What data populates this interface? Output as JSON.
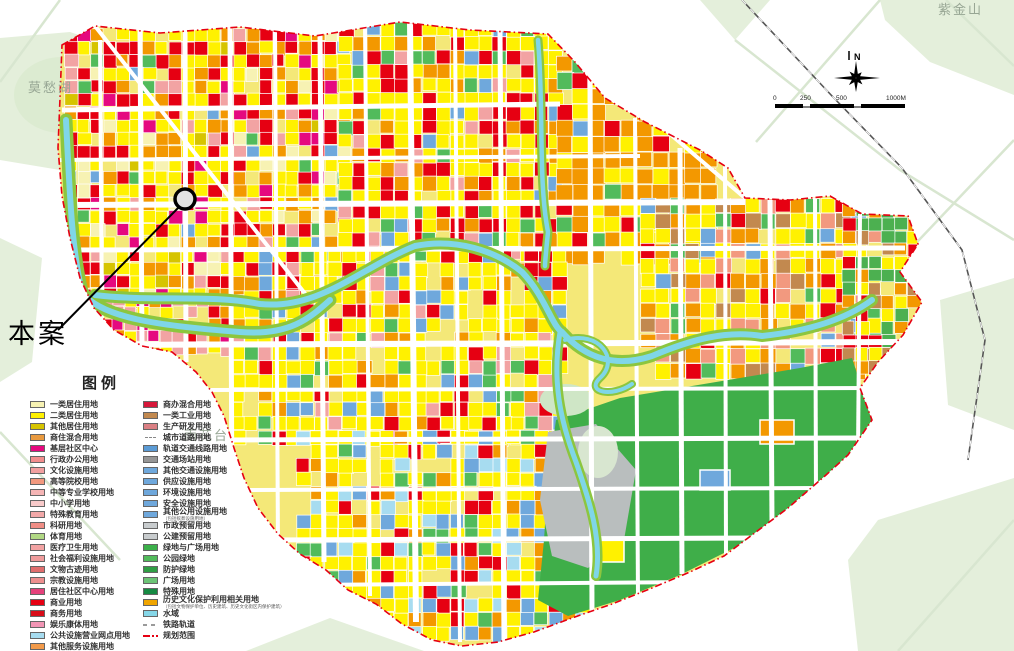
{
  "labels": {
    "site": "本案",
    "mochou_lake": "莫愁湖",
    "yuhuatai": "雨花台",
    "zijinshan": "紫金山",
    "north": "N"
  },
  "scalebar": {
    "ticks": [
      "0",
      "250",
      "500",
      "1000M"
    ]
  },
  "colors": {
    "planning_boundary": "#e60012",
    "water": "#7fd6e8",
    "road": "#ffffff",
    "residential_yellow": "#fff100",
    "commercial_red": "#e60012",
    "mixed_orange": "#f39800",
    "green_space": "#3fae49",
    "park_outside": "#e4efdb"
  },
  "legend": {
    "title": "图例",
    "left": [
      {
        "label": "一类居住用地",
        "color": "#f7f2b3"
      },
      {
        "label": "二类居住用地",
        "color": "#fff100"
      },
      {
        "label": "其他居住用地",
        "color": "#d6c400"
      },
      {
        "label": "商住混合用地",
        "color": "#e99a3f"
      },
      {
        "label": "基层社区中心",
        "color": "#e5097f"
      },
      {
        "label": "行政办公用地",
        "color": "#f28e8e"
      },
      {
        "label": "文化设施用地",
        "color": "#f2a0a0"
      },
      {
        "label": "高等院校用地",
        "color": "#f2997f"
      },
      {
        "label": "中等专业学校用地",
        "color": "#f5b5b5"
      },
      {
        "label": "中小学用地",
        "color": "#f8caca"
      },
      {
        "label": "特殊教育用地",
        "color": "#f2a8a8"
      },
      {
        "label": "科研用地",
        "color": "#f08e86"
      },
      {
        "label": "体育用地",
        "color": "#b1d884"
      },
      {
        "label": "医疗卫生用地",
        "color": "#f2a3a3"
      },
      {
        "label": "社会福利设施用地",
        "color": "#ef9c9c"
      },
      {
        "label": "文物古迹用地",
        "color": "#e06e6e"
      },
      {
        "label": "宗教设施用地",
        "color": "#ed8f8f"
      },
      {
        "label": "居住社区中心用地",
        "color": "#e4417b"
      },
      {
        "label": "商业用地",
        "color": "#e60012"
      },
      {
        "label": "商务用地",
        "color": "#d80c18"
      },
      {
        "label": "娱乐康体用地",
        "color": "#f295b5"
      },
      {
        "label": "公共设施营业网点用地",
        "color": "#a7dcf0"
      },
      {
        "label": "其他服务设施用地",
        "color": "#f39b4b"
      }
    ],
    "right": [
      {
        "label": "商办混合用地",
        "color": "#d6173a"
      },
      {
        "label": "一类工业用地",
        "color": "#c2894f"
      },
      {
        "label": "生产研发用地",
        "color": "#db8084"
      },
      {
        "label": "城市道路用地",
        "type": "road"
      },
      {
        "label": "轨道交通线路用地",
        "color": "#5b9bd5"
      },
      {
        "label": "交通场站用地",
        "color": "#969696"
      },
      {
        "label": "其他交通设施用地",
        "color": "#6fa8dc"
      },
      {
        "label": "供应设施用地",
        "color": "#6fa8dc"
      },
      {
        "label": "环境设施用地",
        "color": "#6fa8dc"
      },
      {
        "label": "安全设施用地",
        "color": "#6fa8dc"
      },
      {
        "label": "其他公用设施用地",
        "color": "#6fa8dc",
        "sub": "（包括殡葬设施用地）"
      },
      {
        "label": "市政预留用地",
        "color": "#c8ccce"
      },
      {
        "label": "公建预留用地",
        "color": "#c8ccce"
      },
      {
        "label": "绿地与广场用地",
        "color": "#3cb04a"
      },
      {
        "label": "公园绿地",
        "color": "#52bb5b"
      },
      {
        "label": "防护绿地",
        "color": "#2f9e44"
      },
      {
        "label": "广场用地",
        "color": "#6cc476"
      },
      {
        "label": "特殊用地",
        "color": "#168a43"
      },
      {
        "label": "历史文化保护利用相关用地",
        "color": "#f0a500",
        "sub": "（包括文物保护单位、历史建筑、历史文化街区内保护建筑）"
      },
      {
        "label": "水域",
        "color": "#86d7e8"
      },
      {
        "label": "铁路轨道",
        "type": "rail"
      },
      {
        "label": "规划范围",
        "type": "boundary"
      }
    ]
  }
}
